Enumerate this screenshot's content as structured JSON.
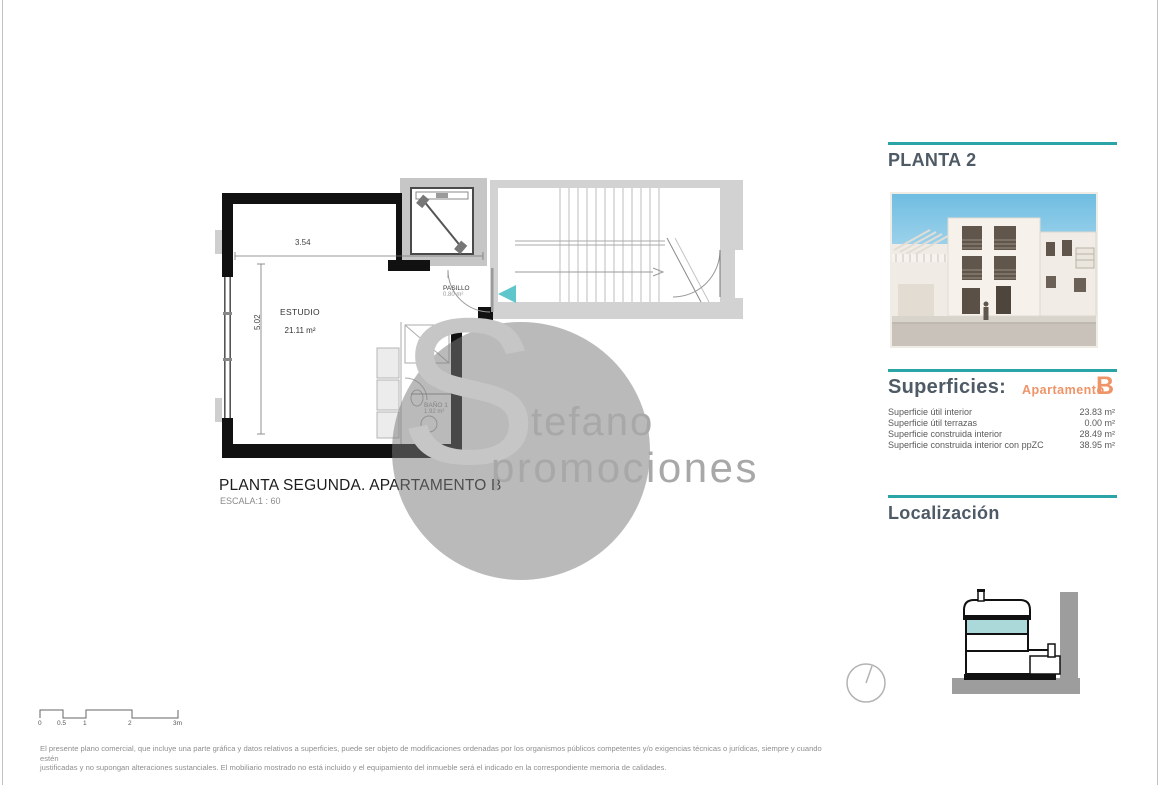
{
  "page": {
    "title": "PLANTA SEGUNDA. APARTAMENTO B",
    "scale_label": "ESCALA:1 : 60",
    "disclaimer_line1": "El presente plano comercial, que incluye una parte gráfica y datos relativos a superficies, puede ser objeto de modificaciones ordenadas por los organismos públicos competentes y/o exigencias técnicas o jurídicas, siempre y cuando estén",
    "disclaimer_line2": "justificadas y no supongan alteraciones sustanciales. El mobiliario mostrado no está incluido y el equipamiento del inmueble será el indicado en la correspondiente memoria de calidades."
  },
  "plan": {
    "rooms": {
      "estudio": {
        "name": "ESTUDIO",
        "area": "21.11 m²"
      },
      "pasillo": {
        "name": "PASILLO",
        "area": "0.80 m²"
      },
      "bano": {
        "name": "BAÑO 1",
        "area": "1.92 m²"
      }
    },
    "dimensions": {
      "width": "3.54",
      "height": "5.02",
      "bath_width": "1.30"
    },
    "scale_bar": {
      "labels": [
        "0",
        "0.5",
        "1",
        "2",
        "3m"
      ]
    }
  },
  "watermark": {
    "initial": "S",
    "line1": "tefano",
    "line2": "promociones"
  },
  "sidebar": {
    "floor_title": "PLANTA 2",
    "superficies": {
      "heading": "Superficies:",
      "apartment_label": "Apartamento",
      "apartment_letter": "B",
      "rows": [
        {
          "label": "Superficie útil interior",
          "value": "23.83 m²"
        },
        {
          "label": "Superficie útil terrazas",
          "value": "0.00 m²"
        },
        {
          "label": "Superficie construida interior",
          "value": "28.49 m²"
        },
        {
          "label": "Superficie construida interior con ppZC",
          "value": "38.95 m²"
        }
      ]
    },
    "localizacion_heading": "Localización"
  },
  "colors": {
    "teal_line": "#2aa4a6",
    "orange_accent": "#ee9468",
    "heading_gray": "#4e5b66",
    "floor_highlight": "#abd9da",
    "entrance_arrow": "#5fc6cb"
  }
}
